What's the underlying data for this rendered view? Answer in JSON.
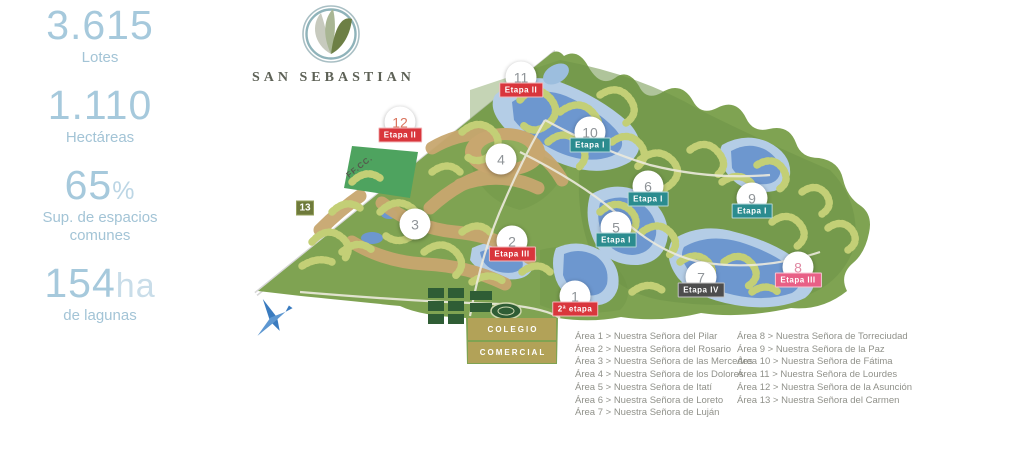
{
  "stats": [
    {
      "value": "3.615",
      "suffix": "",
      "label": "Lotes"
    },
    {
      "value": "1.110",
      "suffix": "",
      "label": "Hectáreas"
    },
    {
      "value": "65",
      "suffix": "%",
      "label": "Sup. de espacios comunes"
    },
    {
      "value": "154",
      "suffix": "ha",
      "label": "de lagunas"
    }
  ],
  "logo": {
    "title": "SAN SEBASTIAN"
  },
  "map": {
    "rail_label": "FF.CC.",
    "colegio_label": "COLEGIO",
    "comercial_label": "COMERCIAL",
    "markers": [
      {
        "number": "1",
        "x": 575,
        "y": 296,
        "shape": "circle",
        "badge": "2ª etapa",
        "badge_color": "red"
      },
      {
        "number": "2",
        "x": 512,
        "y": 241,
        "shape": "circle",
        "badge": "Etapa III",
        "badge_color": "red"
      },
      {
        "number": "3",
        "x": 415,
        "y": 224,
        "shape": "circle"
      },
      {
        "number": "4",
        "x": 501,
        "y": 159,
        "shape": "circle"
      },
      {
        "number": "5",
        "x": 616,
        "y": 227,
        "shape": "circle",
        "badge": "Etapa I",
        "badge_color": "teal"
      },
      {
        "number": "6",
        "x": 648,
        "y": 186,
        "shape": "circle",
        "badge": "Etapa I",
        "badge_color": "teal"
      },
      {
        "number": "7",
        "x": 701,
        "y": 277,
        "shape": "circle",
        "badge": "Etapa IV",
        "badge_color": "dark"
      },
      {
        "number": "8",
        "x": 798,
        "y": 267,
        "shape": "circle",
        "badge": "Etapa III",
        "badge_color": "pink",
        "num_color": "#e089a3"
      },
      {
        "number": "9",
        "x": 752,
        "y": 198,
        "shape": "circle",
        "badge": "Etapa I",
        "badge_color": "teal"
      },
      {
        "number": "10",
        "x": 590,
        "y": 132,
        "shape": "circle",
        "badge": "Etapa I",
        "badge_color": "teal"
      },
      {
        "number": "11",
        "x": 521,
        "y": 77,
        "shape": "circle",
        "badge": "Etapa II",
        "badge_color": "red"
      },
      {
        "number": "12",
        "x": 400,
        "y": 122,
        "shape": "circle",
        "badge": "Etapa II",
        "badge_color": "red",
        "num_color": "#d9755f"
      },
      {
        "number": "13",
        "x": 305,
        "y": 208,
        "shape": "square"
      }
    ]
  },
  "legend": {
    "left": [
      "Área 1 > Nuestra Señora del Pilar",
      "Área 2 > Nuestra Señora del Rosario",
      "Área 3 > Nuestra Señora de las Mercedes",
      "Área 4 > Nuestra Señora de los Dolores",
      "Área 5 > Nuestra Señora de Itatí",
      "Área 6 > Nuestra Señora de Loreto",
      "Área 7 > Nuestra Señora de Luján"
    ],
    "right": [
      "Área 8 > Nuestra Señora de Torreciudad",
      "Área 9 > Nuestra Señora de la Paz",
      "Área 10 > Nuestra Señora de Fátima",
      "Área 11 > Nuestra Señora de Lourdes",
      "Área 12 > Nuestra Señora de la Asunción",
      "Área 13 > Nuestra Señora del Carmen"
    ]
  },
  "colors": {
    "badge_red": "#d9363c",
    "badge_teal": "#2b8c8f",
    "badge_pink": "#e85f86",
    "badge_dark": "#4d4d4d",
    "marker_olive": "#6e7a3b",
    "stat_number": "#a6c9dc",
    "legend_text": "#90918a",
    "land_green": "#7fa352",
    "lagoon_blue": "#6d97cf"
  }
}
